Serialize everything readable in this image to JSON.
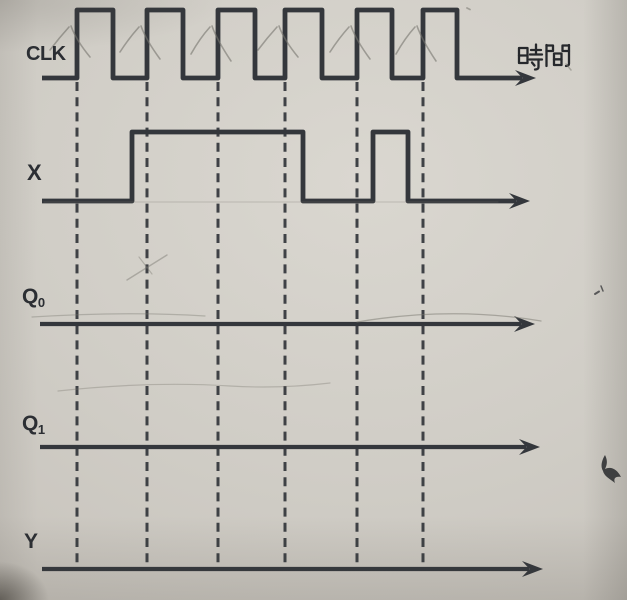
{
  "diagram": {
    "type": "timing-diagram",
    "description": "clocked logic timing chart exercise",
    "time_axis_label": "時間",
    "labels": {
      "clk": "CLK",
      "x": "X",
      "q0": {
        "base": "Q",
        "sub": "0"
      },
      "q1": {
        "base": "Q",
        "sub": "1"
      },
      "y": "Y"
    },
    "colors": {
      "paper": "#cdc9c2",
      "ink": "#34373c",
      "ink_dark": "#26282c",
      "pencil": "#77756e",
      "label": "#2b2e33"
    },
    "geometry": {
      "width": 627,
      "height": 600,
      "gridline_top_y": 82,
      "gridline_bottom_y": 568,
      "clock_edges_x": [
        77,
        147,
        218,
        285,
        357,
        423
      ]
    },
    "signals": [
      {
        "id": "clk",
        "baseline_y": 78,
        "high_y": 10,
        "start_x": 42,
        "arrow_tip_x": 536,
        "stroke_w": 4.8,
        "pulses": [
          [
            77,
            113
          ],
          [
            147,
            183
          ],
          [
            218,
            255
          ],
          [
            285,
            322
          ],
          [
            357,
            392
          ],
          [
            423,
            457
          ]
        ]
      },
      {
        "id": "x",
        "baseline_y": 201,
        "high_y": 132,
        "start_x": 42,
        "arrow_tip_x": 530,
        "stroke_w": 4.8,
        "pulses": [
          [
            132,
            303
          ],
          [
            373,
            408
          ]
        ]
      },
      {
        "id": "q0",
        "baseline_y": 324,
        "high_y": 255,
        "start_x": 40,
        "arrow_tip_x": 535,
        "stroke_w": 4.2,
        "pulses": []
      },
      {
        "id": "q1",
        "baseline_y": 447,
        "high_y": 378,
        "start_x": 40,
        "arrow_tip_x": 540,
        "stroke_w": 4.2,
        "pulses": []
      },
      {
        "id": "y",
        "baseline_y": 569,
        "high_y": 500,
        "start_x": 42,
        "arrow_tip_x": 543,
        "stroke_w": 4.2,
        "pulses": []
      }
    ],
    "pencil_checkmarks_x": [
      77,
      147,
      218,
      285,
      357,
      423
    ],
    "pencil_marks": [
      {
        "d": "M127,280 L167,255",
        "w": 1.4,
        "o": 0.45
      },
      {
        "d": "M139,257 L152,274",
        "w": 1.2,
        "o": 0.4
      },
      {
        "d": "M357,322 Q452,306 541,321",
        "w": 1.3,
        "o": 0.5
      },
      {
        "d": "M32,317 Q130,311 205,316",
        "w": 1.2,
        "o": 0.38
      },
      {
        "d": "M58,391 Q150,381 230,386 Q280,389 330,383",
        "w": 1.2,
        "o": 0.35
      },
      {
        "d": "M44,202 H498",
        "w": 1.1,
        "o": 0.3
      },
      {
        "d": "M566,64 l5,6",
        "w": 1.5,
        "o": 0.5
      },
      {
        "d": "M467,8 l3,1.5",
        "w": 1.8,
        "o": 0.55
      }
    ],
    "ink_marks": [
      {
        "d": "M605,455 c3,6 2,10 0,14 c6,-3 12,0 16,8 c-5,-1 -8,1 -6,6 c-5,-4 -11,-7 -12,-12 c-3,-5 -1,-11 2,-16 z",
        "fill": true,
        "o": 0.85
      },
      {
        "d": "M595,294 l4,-2.5",
        "fill": false,
        "w": 2.0,
        "o": 0.7
      },
      {
        "d": "M601,286 l2,5",
        "fill": false,
        "w": 1.5,
        "o": 0.7
      }
    ],
    "time_glyph_paths": [
      "M519,48 h8.5 v15 h-8.5 z",
      "M519,55.5 h8.5",
      "M531,50 h10",
      "M536,44.5 v9.5",
      "M530,54.5 h12",
      "M529.5,59.5 h12.5",
      "M538.5,59.5 v7.5 q0,2.5 -3.5,2.5",
      "M532,62.5 l2.5,3",
      "M546.5,45 v21",
      "M546.5,45.5 h6.5 v5.5 h-6.5",
      "M569,45.5 h-6.5 v5.5 h6.5",
      "M569,45 v18.5 q0,2.5 -3,2.5",
      "M554,53.5 h7.5 v11.5 h-7.5 z",
      "M554,59.3 h7.5"
    ]
  }
}
